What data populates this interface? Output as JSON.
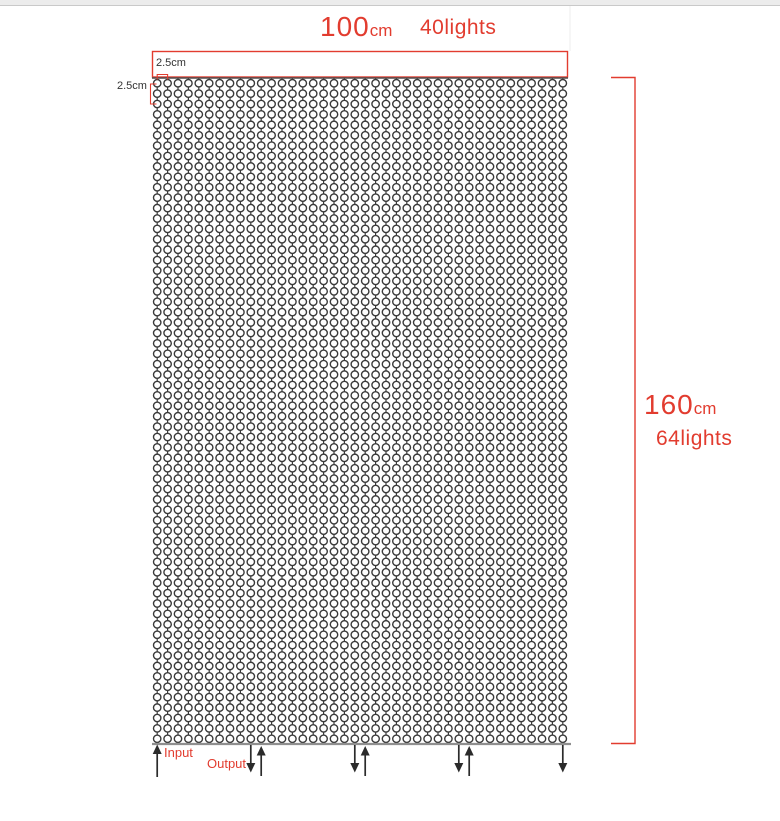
{
  "colors": {
    "accent": "#e23c2f",
    "wire": "#3a3a3a",
    "rail_top": "#4d4d4d",
    "rail_bottom": "#8f8f8f",
    "arrow": "#2b2b2b",
    "band": "#ececec"
  },
  "header": {
    "width_value": "100",
    "width_unit": "cm",
    "width_lights": "40lights"
  },
  "side": {
    "height_value": "160",
    "height_unit": "cm",
    "height_lights": "64lights"
  },
  "spacing_labels": {
    "top": "2.5cm",
    "left": "2.5cm"
  },
  "io_labels": {
    "input": "Input",
    "output": "Output"
  },
  "grid": {
    "columns": 40,
    "rows": 64,
    "left": 152,
    "right": 568,
    "top_rail_y": 78,
    "bottom_rail_y": 744,
    "circle_radius": 3.7,
    "frame": {
      "x": 152.5,
      "y": 51.5,
      "width": 415,
      "height": 25.5
    },
    "height_bracket": {
      "x_inner": 611,
      "x_outer": 635,
      "y_top": 77.5,
      "y_bottom": 743.5
    },
    "col_bracket": {
      "y_base": 79.5,
      "rise": 5
    },
    "row_bracket": {
      "x": 150.5,
      "y1": 84,
      "y2": 104,
      "tick": 6
    },
    "wiring": {
      "input_column": 1,
      "output_down_columns": [
        10,
        20,
        30,
        40
      ],
      "output_up_columns": [
        11,
        21,
        31
      ]
    }
  }
}
